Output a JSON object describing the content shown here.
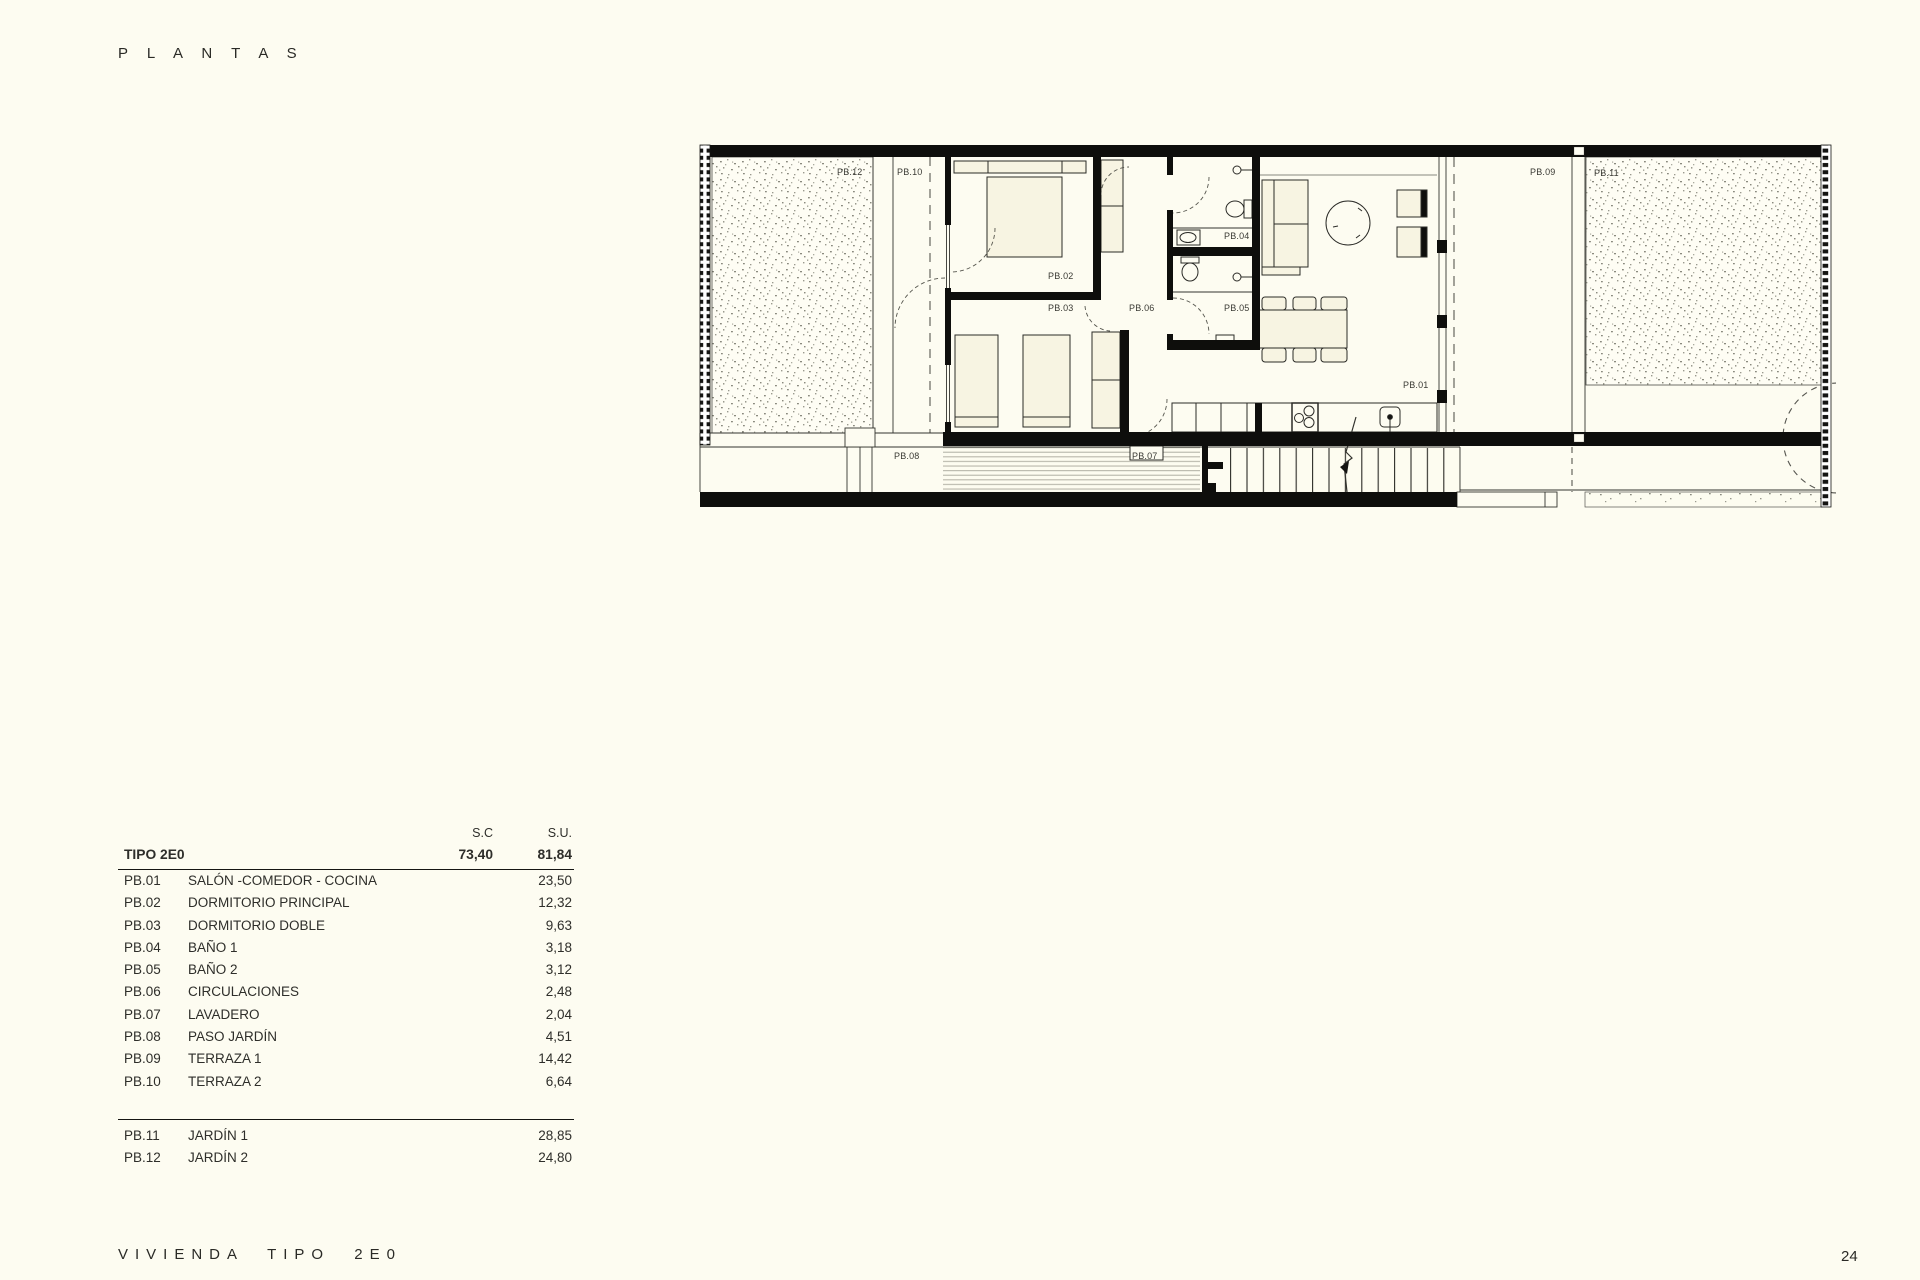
{
  "page": {
    "title": "P L A N T A S",
    "footer_title": "VIVIENDA TIPO 2E0",
    "page_number": "24"
  },
  "plan": {
    "labels": {
      "pb01": "PB.01",
      "pb02": "PB.02",
      "pb03": "PB.03",
      "pb04": "PB.04",
      "pb05": "PB.05",
      "pb06": "PB.06",
      "pb07": "PB.07",
      "pb08": "PB.08",
      "pb09": "PB.09",
      "pb10": "PB.10",
      "pb11": "PB.11",
      "pb12": "PB.12"
    }
  },
  "table": {
    "headers": {
      "sc": "S.C",
      "su": "S.U."
    },
    "type_row": {
      "label": "TIPO 2E0",
      "sc": "73,40",
      "su": "81,84"
    },
    "rows": [
      {
        "code": "PB.01",
        "name": "SALÓN -COMEDOR - COCINA",
        "su": "23,50"
      },
      {
        "code": "PB.02",
        "name": "DORMITORIO PRINCIPAL",
        "su": "12,32"
      },
      {
        "code": "PB.03",
        "name": "DORMITORIO DOBLE",
        "su": "9,63"
      },
      {
        "code": "PB.04",
        "name": "BAÑO 1",
        "su": "3,18"
      },
      {
        "code": "PB.05",
        "name": "BAÑO 2",
        "su": "3,12"
      },
      {
        "code": "PB.06",
        "name": "CIRCULACIONES",
        "su": "2,48"
      },
      {
        "code": "PB.07",
        "name": "LAVADERO",
        "su": "2,04"
      },
      {
        "code": "PB.08",
        "name": "PASO JARDÍN",
        "su": "4,51"
      },
      {
        "code": "PB.09",
        "name": "TERRAZA 1",
        "su": "14,42"
      },
      {
        "code": "PB.10",
        "name": "TERRAZA 2",
        "su": "6,64"
      }
    ],
    "garden_rows": [
      {
        "code": "PB.11",
        "name": "JARDÍN 1",
        "su": "28,85"
      },
      {
        "code": "PB.12",
        "name": "JARDÍN 2",
        "su": "24,80"
      }
    ]
  },
  "colors": {
    "paper": "#fdfcf1",
    "ink": "#262622",
    "wall": "#0e0e0c",
    "texture_dot": "#8a8a7e"
  }
}
